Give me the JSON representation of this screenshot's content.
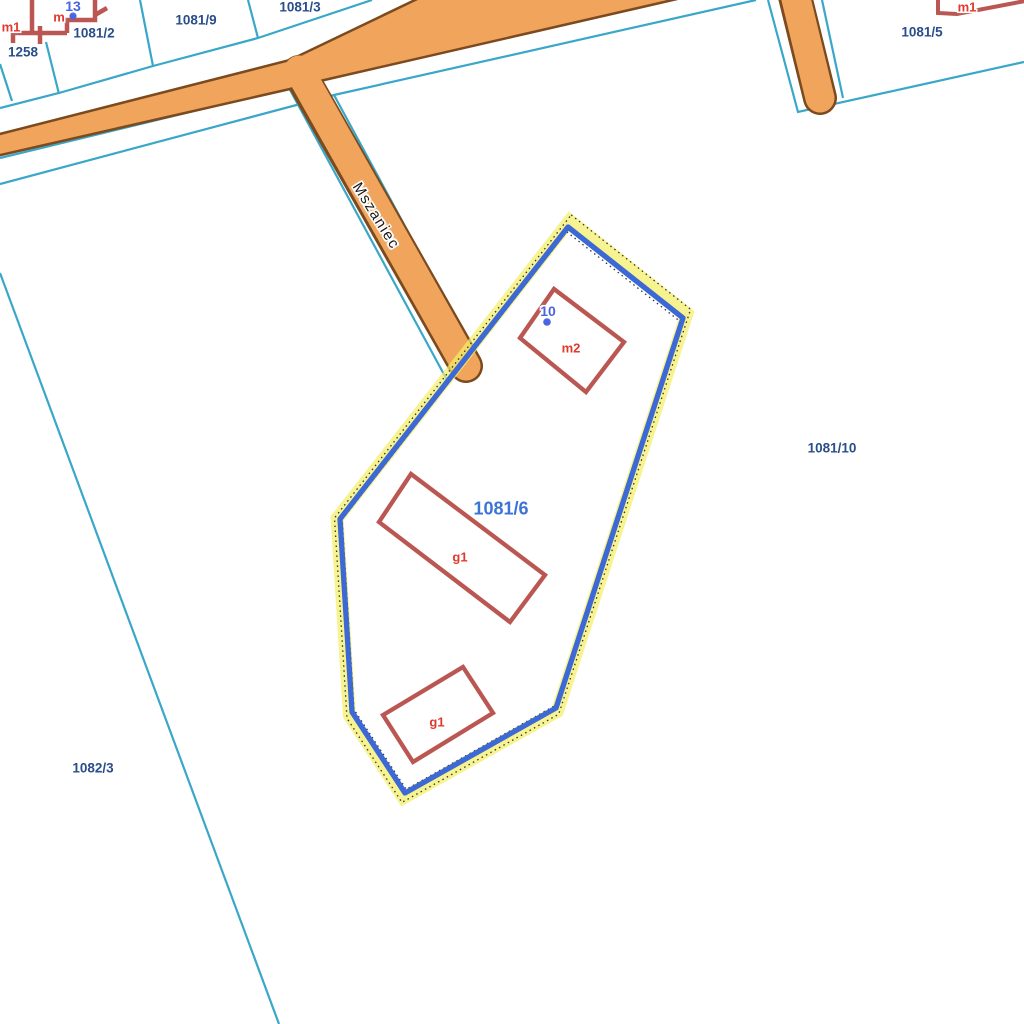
{
  "app": {
    "type": "cadastral-map-viewer",
    "selected_parcel": {
      "number": "1081/6",
      "address_point": "10",
      "buildings": [
        "m2",
        "g1",
        "g1"
      ]
    },
    "street": {
      "name": "Mszaniec"
    }
  },
  "labels": {
    "parcel_1258": "1258",
    "parcel_1081_2": "1081/2",
    "parcel_1081_9": "1081/9",
    "parcel_1081_3": "1081/3",
    "parcel_1081_5": "1081/5",
    "parcel_1081_10": "1081/10",
    "parcel_1082_3": "1082/3",
    "parcel_selected": "1081/6",
    "street": "Mszaniec",
    "building_m1_left": "m1",
    "building_m_left": "m",
    "building_m1_right": "m1",
    "building_m2": "m2",
    "building_g1_north": "g1",
    "building_g1_south": "g1",
    "address_13": "13",
    "address_10": "10"
  },
  "colors": {
    "background": "#FFFFFF",
    "parcel_line": "#3AA7C8",
    "road_fill": "#F0A45C",
    "road_edge": "#7B4A1E",
    "building_outline": "#BB5752",
    "building_label": "#E03A2E",
    "parcel_label": "#2A4E8A",
    "selected_parcel_label": "#3B73D6",
    "address_point": "#4B64E0",
    "street_label": "#1A1A1A",
    "selection_outline": "#3C69D6",
    "selection_glow": "rgba(244,238,102,0.72)",
    "selection_tick": "#333333"
  }
}
